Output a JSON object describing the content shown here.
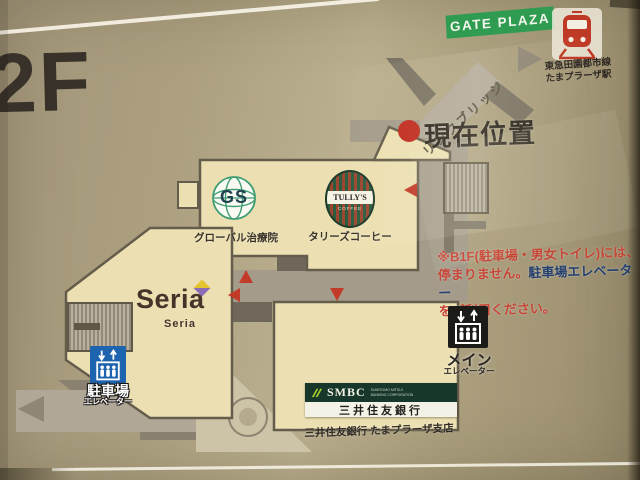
{
  "floor_label": "2F",
  "gate_plaza_label": "GATE PLAZA",
  "station": {
    "line_name": "東急田園都市線",
    "station_name": "たまプラーザ駅"
  },
  "bridge_label": "リンクブリッジ",
  "current_location_label": "現在位置",
  "tenants": {
    "global_clinic": {
      "initials": "GS",
      "caption": "グローバル治療院"
    },
    "tullys": {
      "name": "TULLY'S",
      "sub": "COFFEE",
      "caption": "タリーズコーヒー"
    },
    "seria": {
      "name": "Seria",
      "caption": "Seria"
    },
    "smbc": {
      "name": "SMBC",
      "sub1": "SUMITOMO MITSUI",
      "sub2": "BANKING CORPORATION",
      "bank_label": "三井住友銀行",
      "caption": "三井住友銀行 たまプラーザ支店"
    }
  },
  "notice": {
    "line1": "※B1F(駐車場・男女トイレ)には、",
    "line2_part1": "停まりません。",
    "line2_part2": "駐車場エレベーター",
    "line3": "をご利用ください。"
  },
  "elevators": {
    "main": {
      "label": "メイン",
      "sublabel": "エレベーター"
    },
    "parking": {
      "label": "駐車場",
      "sublabel": "エレベーター"
    }
  },
  "colors": {
    "accent_red": "#c23a28",
    "notice_navy": "#25406f",
    "gate_green": "#2f9c52",
    "building_cream": "#ece0b2",
    "corridor_gray": "#a49b8b",
    "elevator_blue": "#1e63ae",
    "smbc_green": "#17372a",
    "smbc_lime": "#a6d02e"
  }
}
